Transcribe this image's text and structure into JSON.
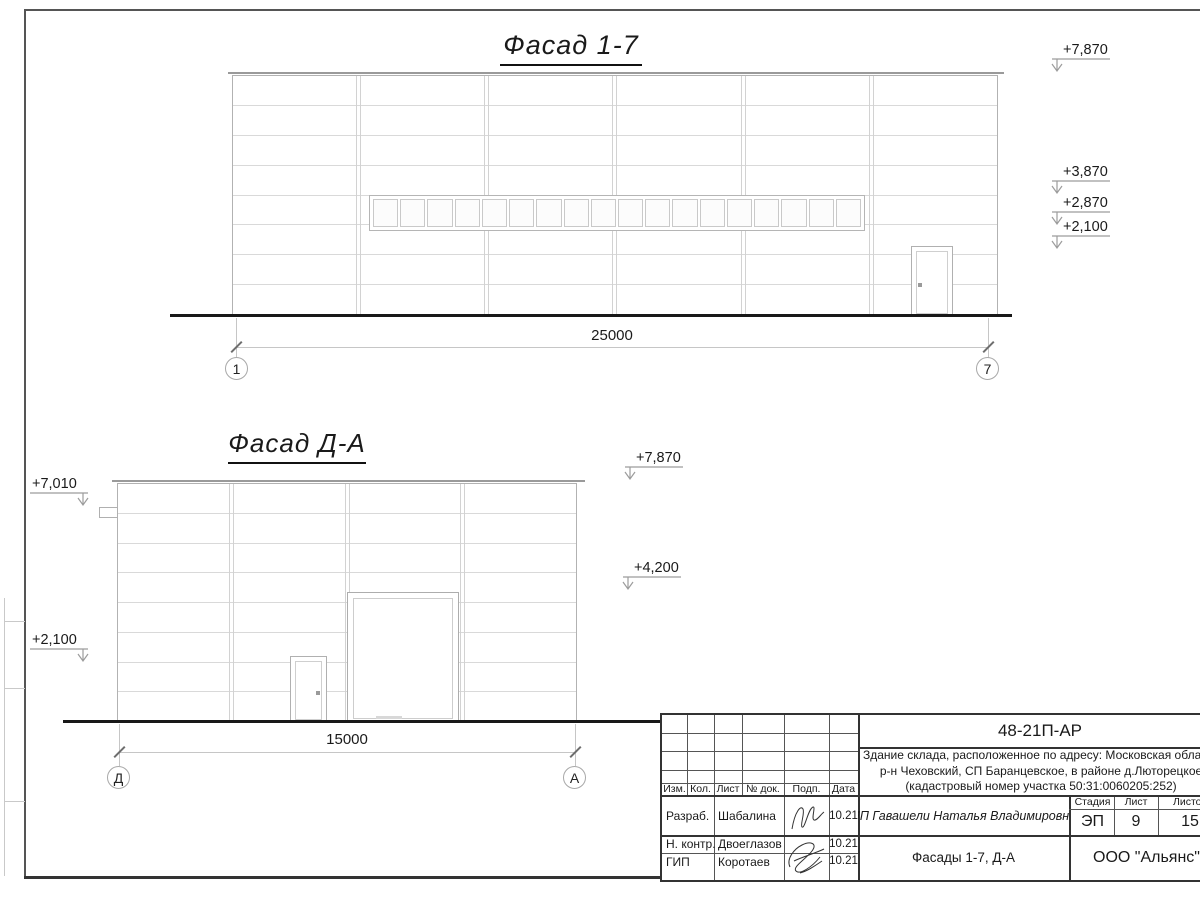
{
  "facade_top": {
    "title": "Фасад 1-7",
    "dimension_label": "25000",
    "axis_start": "1",
    "axis_end": "7",
    "elevation_marks": [
      "+7,870",
      "+3,870",
      "+2,870",
      "+2,100"
    ]
  },
  "facade_side": {
    "title": "Фасад Д-А",
    "dimension_label": "15000",
    "axis_start": "Д",
    "axis_end": "А",
    "elevation_marks_left": [
      "+7,010",
      "+2,100"
    ],
    "elevation_marks_right": [
      "+7,870",
      "+4,200"
    ]
  },
  "title_block": {
    "document_code": "48-21П-АР",
    "description_line1": "Здание склада, расположенное по адресу: Московская область",
    "description_line2": "р-н Чеховский, СП Баранцевское, в районе д.Люторецкое",
    "description_line3": "(кадастровый номер участка 50:31:0060205:252)",
    "columns": {
      "izm": "Изм.",
      "kol": "Кол.",
      "list": "Лист",
      "doc": "№ док.",
      "podp": "Подп.",
      "data": "Дата"
    },
    "signers": [
      {
        "role": "Разраб.",
        "name": "Шабалина",
        "date": "10.21"
      },
      {
        "role": "Н. контр.",
        "name": "Двоеглазов",
        "date": "10.21"
      },
      {
        "role": "ГИП",
        "name": "Коротаев",
        "date": "10.21"
      }
    ],
    "client": "ИП Гавашели Наталья Владимировна",
    "stage_label": "Стадия",
    "sheet_label": "Лист",
    "sheets_label": "Листов",
    "stage": "ЭП",
    "sheet_number": "9",
    "sheets_total": "15",
    "drawing_title": "Фасады 1-7, Д-А",
    "company": "ООО \"Альянс\""
  }
}
